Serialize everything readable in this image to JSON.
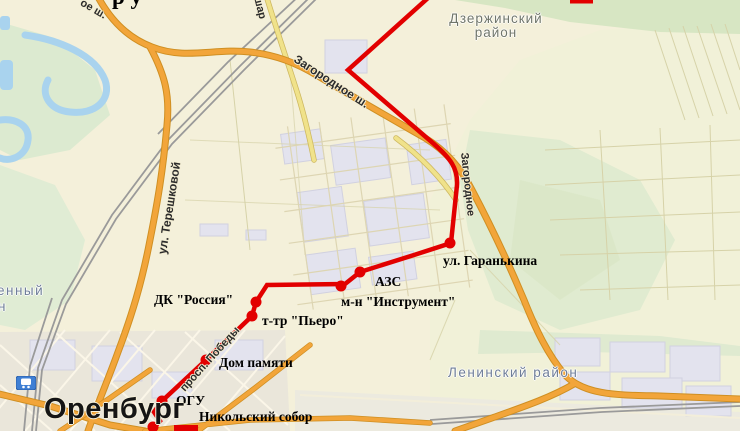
{
  "title_fragment": "р у",
  "map": {
    "city": "Оренбург",
    "districts": {
      "dzerzhinsky": "Дзержинский район",
      "leninsky": "Ленинский район",
      "left_edge_fragment_line1": "енный",
      "left_edge_fragment_line2": "н"
    }
  },
  "roads": {
    "zagorodnoe_diagonal": "Загородное ш.",
    "zagorodnoe_vertical": "Загородное",
    "tereshkovoy": "ул. Терешковой",
    "pobedy": "просп. Победы",
    "shar_fragment": "шар",
    "top_left_fragment": "ое ш."
  },
  "route": {
    "color": "#e20000",
    "stops": [
      {
        "label": "ул. Гаранькина"
      },
      {
        "label": "АЗС"
      },
      {
        "label": "м-н \"Инструмент\""
      },
      {
        "label": "ДК \"Россия\""
      },
      {
        "label": "т-тр \"Пьеро\""
      },
      {
        "label": "Дом памяти"
      },
      {
        "label": "ОГУ"
      },
      {
        "label": "Никольский собор"
      }
    ]
  },
  "icons": {
    "railway_station": "train-in-blue-square"
  },
  "colors": {
    "route_red": "#e20000",
    "highway_orange": "#f2a53a",
    "minor_road_yellow": "#f0e28a",
    "green_area": "#dcead0",
    "water_blue": "#a9d3ee",
    "urban_block": "#e3e3ee",
    "map_background": "#f4f0da"
  }
}
